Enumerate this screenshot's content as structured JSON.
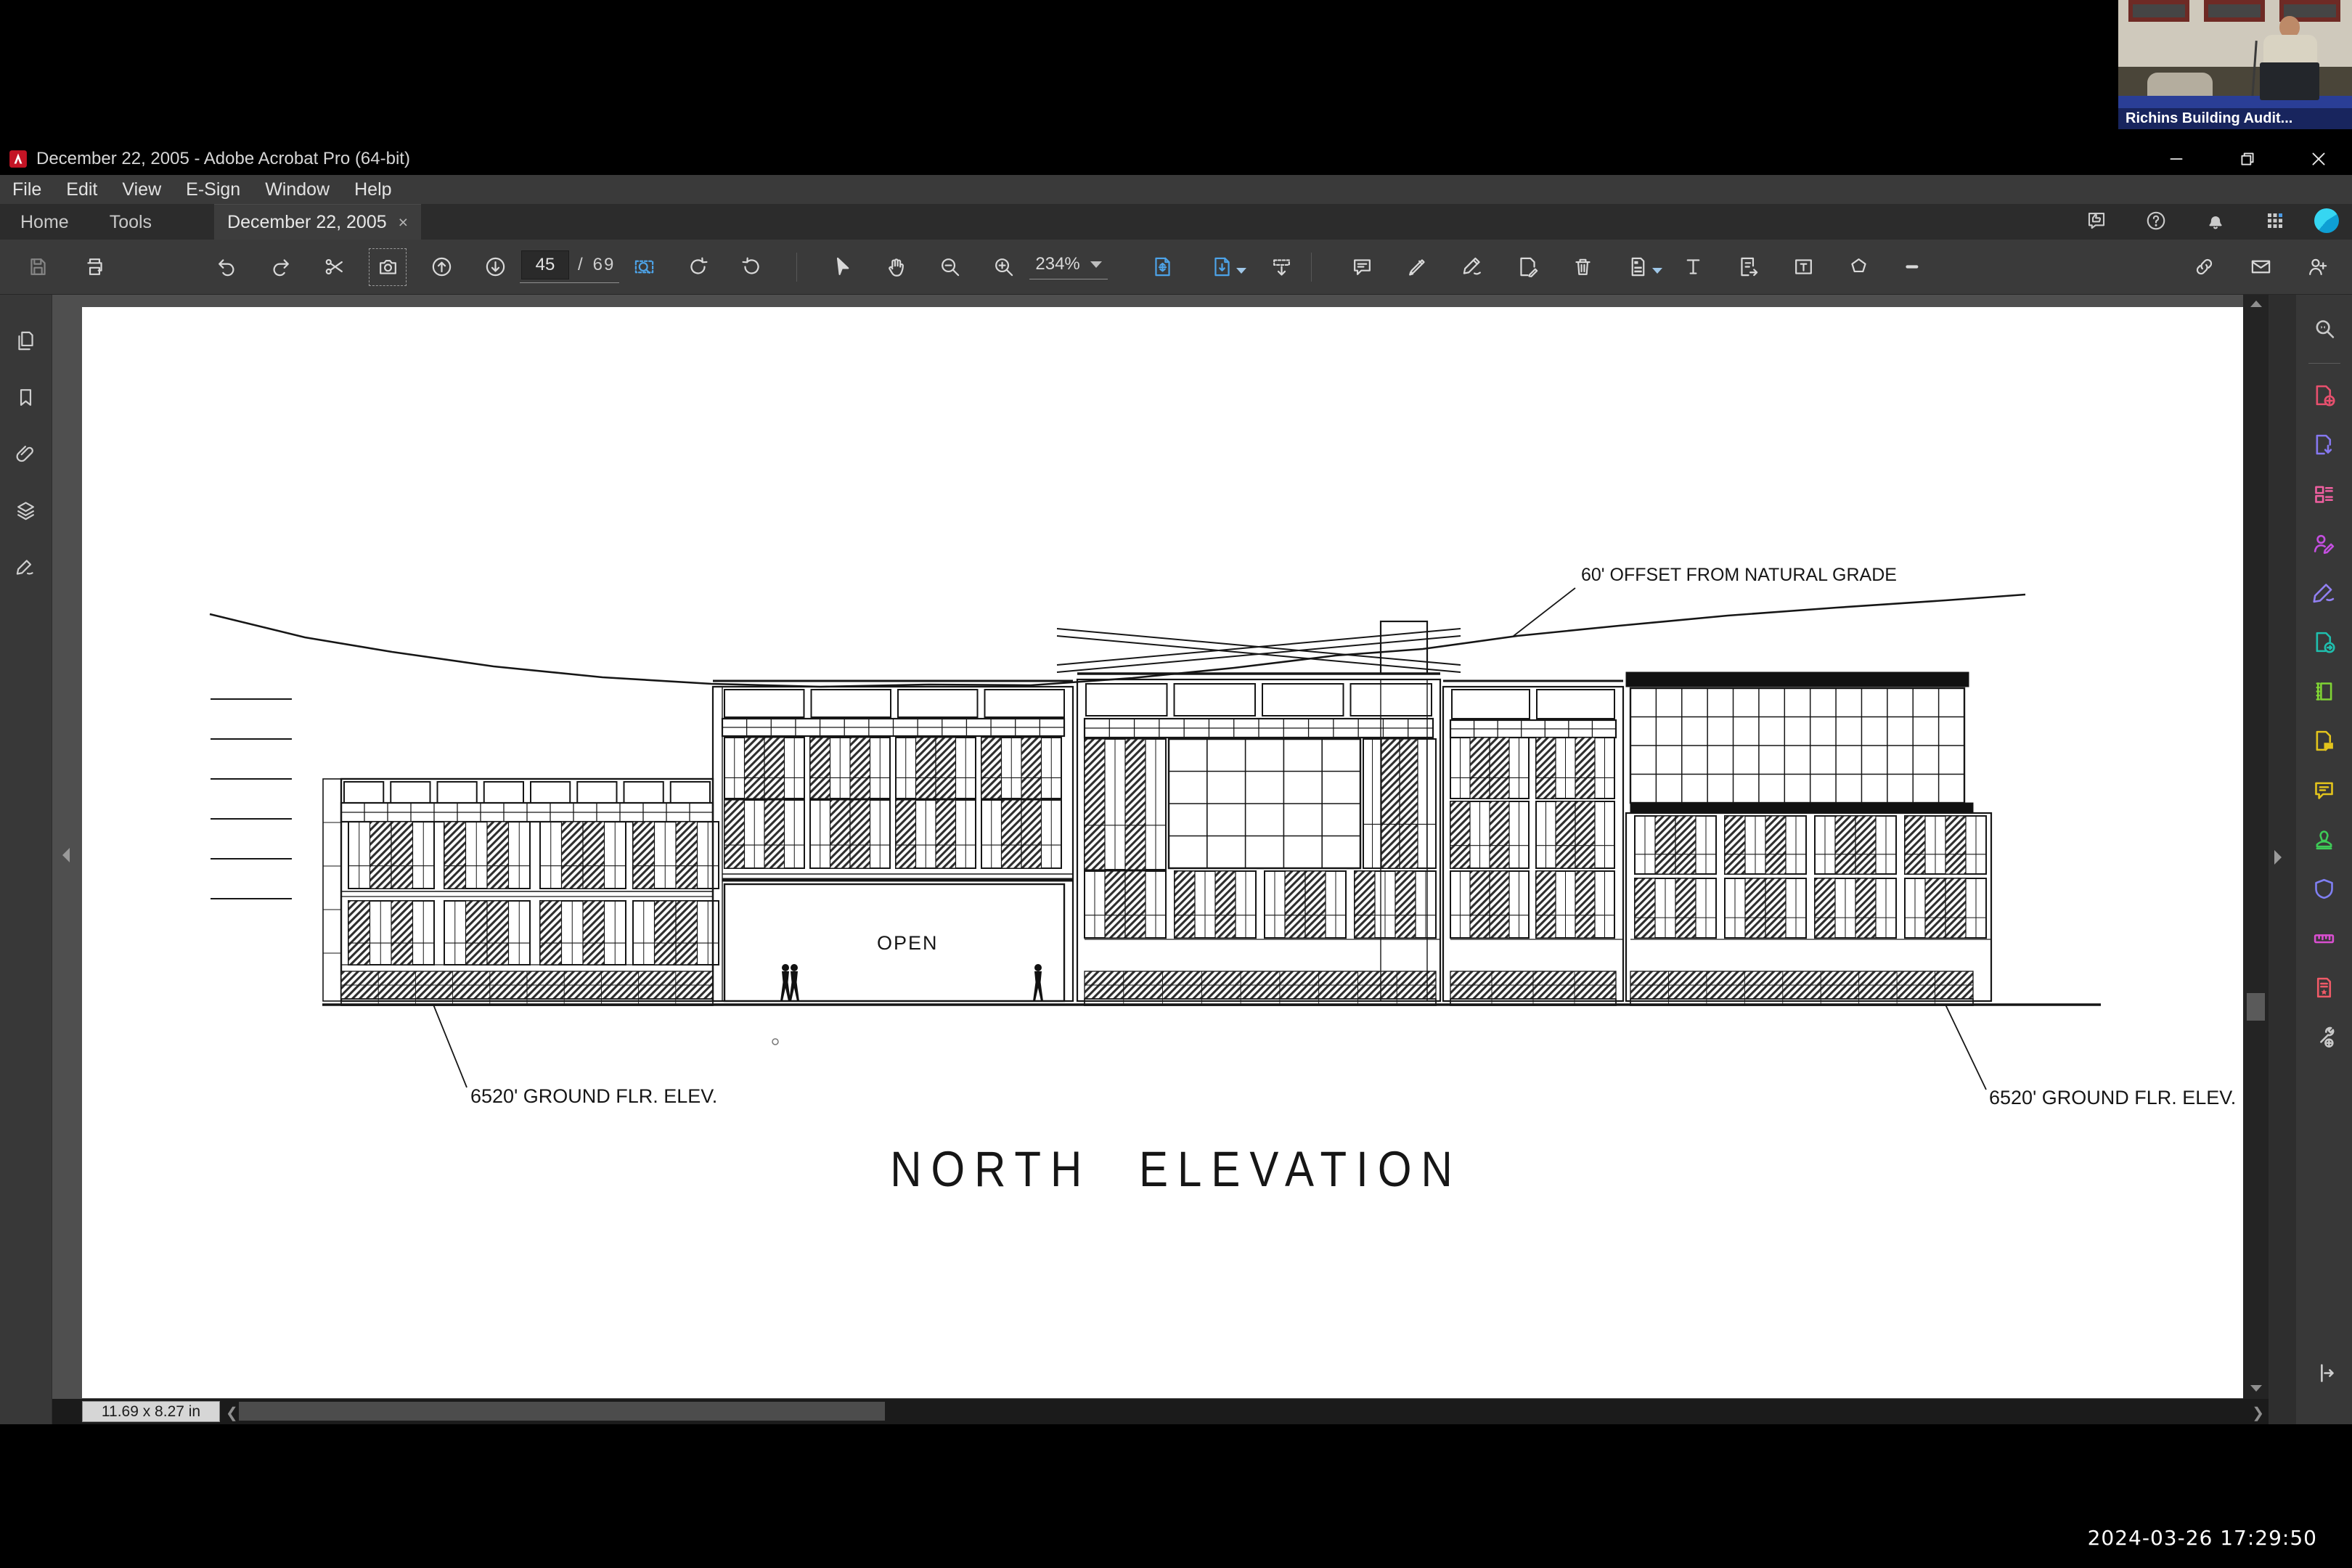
{
  "window": {
    "title": "December 22, 2005 - Adobe Acrobat Pro (64-bit)",
    "controls": [
      {
        "name": "minimize-icon"
      },
      {
        "name": "restore-icon"
      },
      {
        "name": "close-icon"
      }
    ]
  },
  "menu": {
    "items": [
      "File",
      "Edit",
      "View",
      "E-Sign",
      "Window",
      "Help"
    ]
  },
  "tabs": {
    "home": "Home",
    "tools": "Tools",
    "document": "December 22, 2005",
    "close": "×"
  },
  "tabbar_icons": [
    {
      "name": "share-feedback-icon"
    },
    {
      "name": "help-icon"
    },
    {
      "name": "notifications-icon"
    },
    {
      "name": "app-grid-icon"
    }
  ],
  "toolbar": {
    "file_icons": [
      {
        "name": "save-icon",
        "disabled": true
      },
      {
        "name": "print-icon"
      }
    ],
    "nav_icons_1": [
      {
        "name": "undo-icon"
      },
      {
        "name": "redo-icon"
      },
      {
        "name": "snapshot-icon"
      },
      {
        "name": "camera-icon",
        "selected": true
      },
      {
        "name": "page-up-icon"
      },
      {
        "name": "page-down-icon"
      }
    ],
    "page": {
      "current": "45",
      "separator": "/",
      "total": "69"
    },
    "nav_icons_2": [
      {
        "name": "marquee-zoom-icon",
        "accent": true
      },
      {
        "name": "rotate-right-icon"
      },
      {
        "name": "rotate-left-icon"
      },
      {
        "name": "sep"
      },
      {
        "name": "select-icon"
      },
      {
        "name": "hand-icon"
      },
      {
        "name": "zoom-out-icon"
      },
      {
        "name": "zoom-in-icon"
      }
    ],
    "zoom": {
      "level": "234%"
    },
    "convert_icons": [
      {
        "name": "export-pdf-icon",
        "accent": true
      },
      {
        "name": "create-pdf-icon",
        "accent": true,
        "caret": true
      },
      {
        "name": "toolbar-download-icon"
      }
    ],
    "annotate_icons": [
      {
        "name": "comment-icon"
      },
      {
        "name": "highlight-icon"
      },
      {
        "name": "sign-icon"
      },
      {
        "name": "edit-page-icon"
      },
      {
        "name": "delete-pages-icon"
      },
      {
        "name": "page-template-icon",
        "caret": true
      },
      {
        "name": "add-text-icon"
      },
      {
        "name": "edit-text-icon"
      },
      {
        "name": "text-box-icon"
      },
      {
        "name": "polygon-icon"
      },
      {
        "name": "line-icon"
      }
    ],
    "share_icons": [
      {
        "name": "link-icon"
      },
      {
        "name": "email-icon"
      },
      {
        "name": "add-user-icon"
      }
    ]
  },
  "left_sidebar": {
    "items": [
      {
        "name": "page-thumbnails-icon"
      },
      {
        "name": "bookmarks-icon"
      },
      {
        "name": "attachments-icon"
      },
      {
        "name": "layers-icon"
      },
      {
        "name": "signatures-icon"
      }
    ]
  },
  "right_sidebar": {
    "items": [
      {
        "name": "search-document-icon",
        "color": "#c9c9c9"
      },
      {
        "name": "create-pdf-tool-icon",
        "color": "#e8506e"
      },
      {
        "name": "export-pdf-tool-icon",
        "color": "#8678f0"
      },
      {
        "name": "organize-pages-icon",
        "color": "#ef5fa0"
      },
      {
        "name": "request-signatures-icon",
        "color": "#c44fe0"
      },
      {
        "name": "fill-sign-icon",
        "color": "#9180f2"
      },
      {
        "name": "send-for-review-icon",
        "color": "#1fbfae"
      },
      {
        "name": "scan-ocr-icon",
        "color": "#7fd334"
      },
      {
        "name": "comment-doc-icon",
        "color": "#e3c41c"
      },
      {
        "name": "comment-tool-icon",
        "color": "#e3c41c"
      },
      {
        "name": "stamp-icon",
        "color": "#3ecb57"
      },
      {
        "name": "protect-icon",
        "color": "#7f7ff2"
      },
      {
        "name": "measure-icon",
        "color": "#d94fd0"
      },
      {
        "name": "pdf-standards-icon",
        "color": "#ef5a67"
      },
      {
        "name": "more-tools-icon",
        "color": "#c9c9c9"
      }
    ]
  },
  "document": {
    "annotations": {
      "offset": "60' OFFSET FROM NATURAL GRADE",
      "ground_left": "6520' GROUND FLR. ELEV.",
      "ground_right": "6520' GROUND FLR. ELEV.",
      "open": "OPEN",
      "title": "NORTH ELEVATION"
    }
  },
  "status_bar": {
    "dimensions": "11.69 x 8.27 in"
  },
  "webcam": {
    "label": "Richins Building Audit..."
  },
  "overlay": {
    "timestamp": "2024-03-26 17:29:50"
  }
}
